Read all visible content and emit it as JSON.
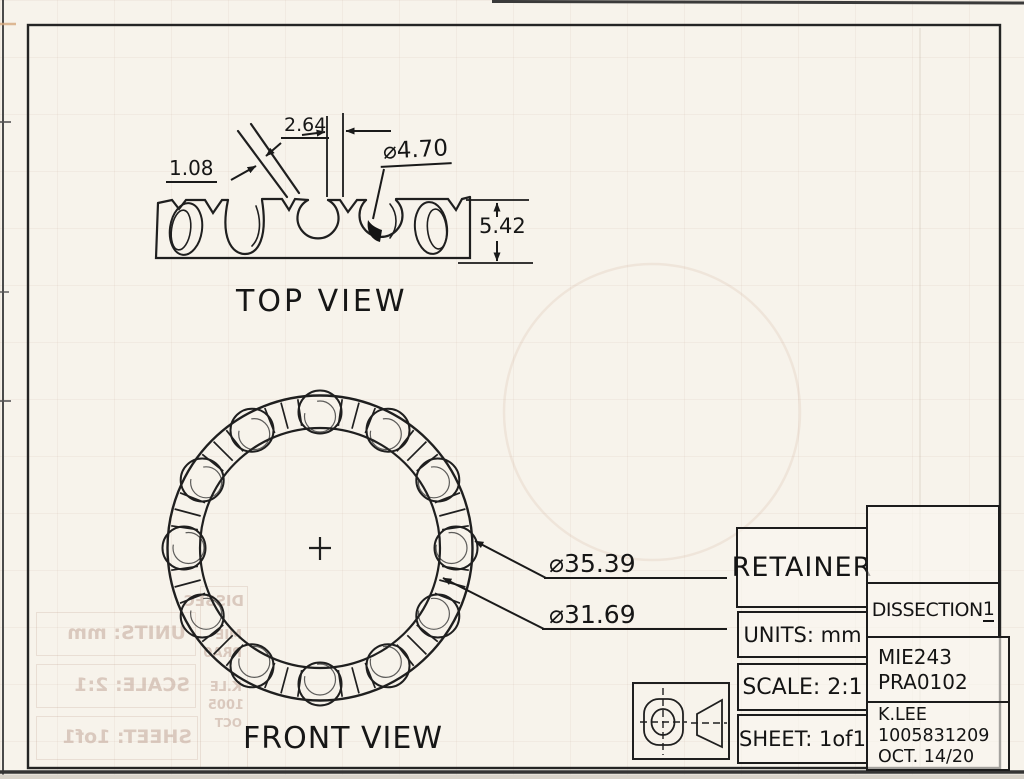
{
  "views": {
    "top_label": "TOP VIEW",
    "front_label": "FRONT VIEW"
  },
  "dims": {
    "notch_width": "1.08",
    "slot_width": "2.64",
    "pocket_diameter": "⌀4.70",
    "section_height": "5.42",
    "outer_diameter": "⌀35.39",
    "inner_diameter": "⌀31.69"
  },
  "title_block": {
    "part_name": "RETAINER",
    "units": "UNITS: mm",
    "scale": "SCALE: 2:1",
    "sheet": "SHEET: 1of1",
    "project": "DISSECTION",
    "project_num": "1",
    "course_code": "MIE243",
    "practical_code": "PRA0102",
    "author": "K.LEE",
    "student_number": "1005831209",
    "date": "OCT. 14/20"
  },
  "ghost": {
    "lines": [
      "DISSEC",
      "UNITS: mm",
      "MIE",
      "PRA0",
      "SCALE: 2:1",
      "K.LE",
      "1005",
      "SHEET: 1of1",
      "OCT"
    ]
  }
}
